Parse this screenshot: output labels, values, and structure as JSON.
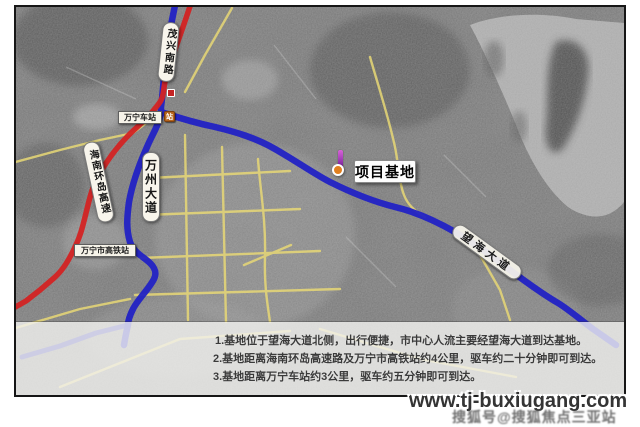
{
  "map": {
    "labels": {
      "maoxing_road": "茂兴南路",
      "wanning_station": "万宁车站",
      "hainan_expressway": "海南环岛高速",
      "wanzhou_avenue": "万州大道",
      "hsr_station": "万宁市高铁站",
      "project_base": "项目基地",
      "wanghai_avenue": "望海大道"
    },
    "colors": {
      "expressway_red": "#d32323",
      "avenue_blue": "#2222c4",
      "minor_yellow": "#e8d876"
    }
  },
  "caption": {
    "lines": [
      "1.基地位于望海大道北侧，出行便捷，市中心人流主要经望海大道到达基地。",
      "2.基地距离海南环岛高速路及万宁市高铁站约4公里，驱车约二十分钟即可到达。",
      "3.基地距离万宁车站约3公里，驱车约五分钟即可到达。"
    ]
  },
  "watermark": {
    "url": "www.tj-buxiugang.com",
    "secondary": "搜狐号@搜狐焦点三亚站"
  }
}
